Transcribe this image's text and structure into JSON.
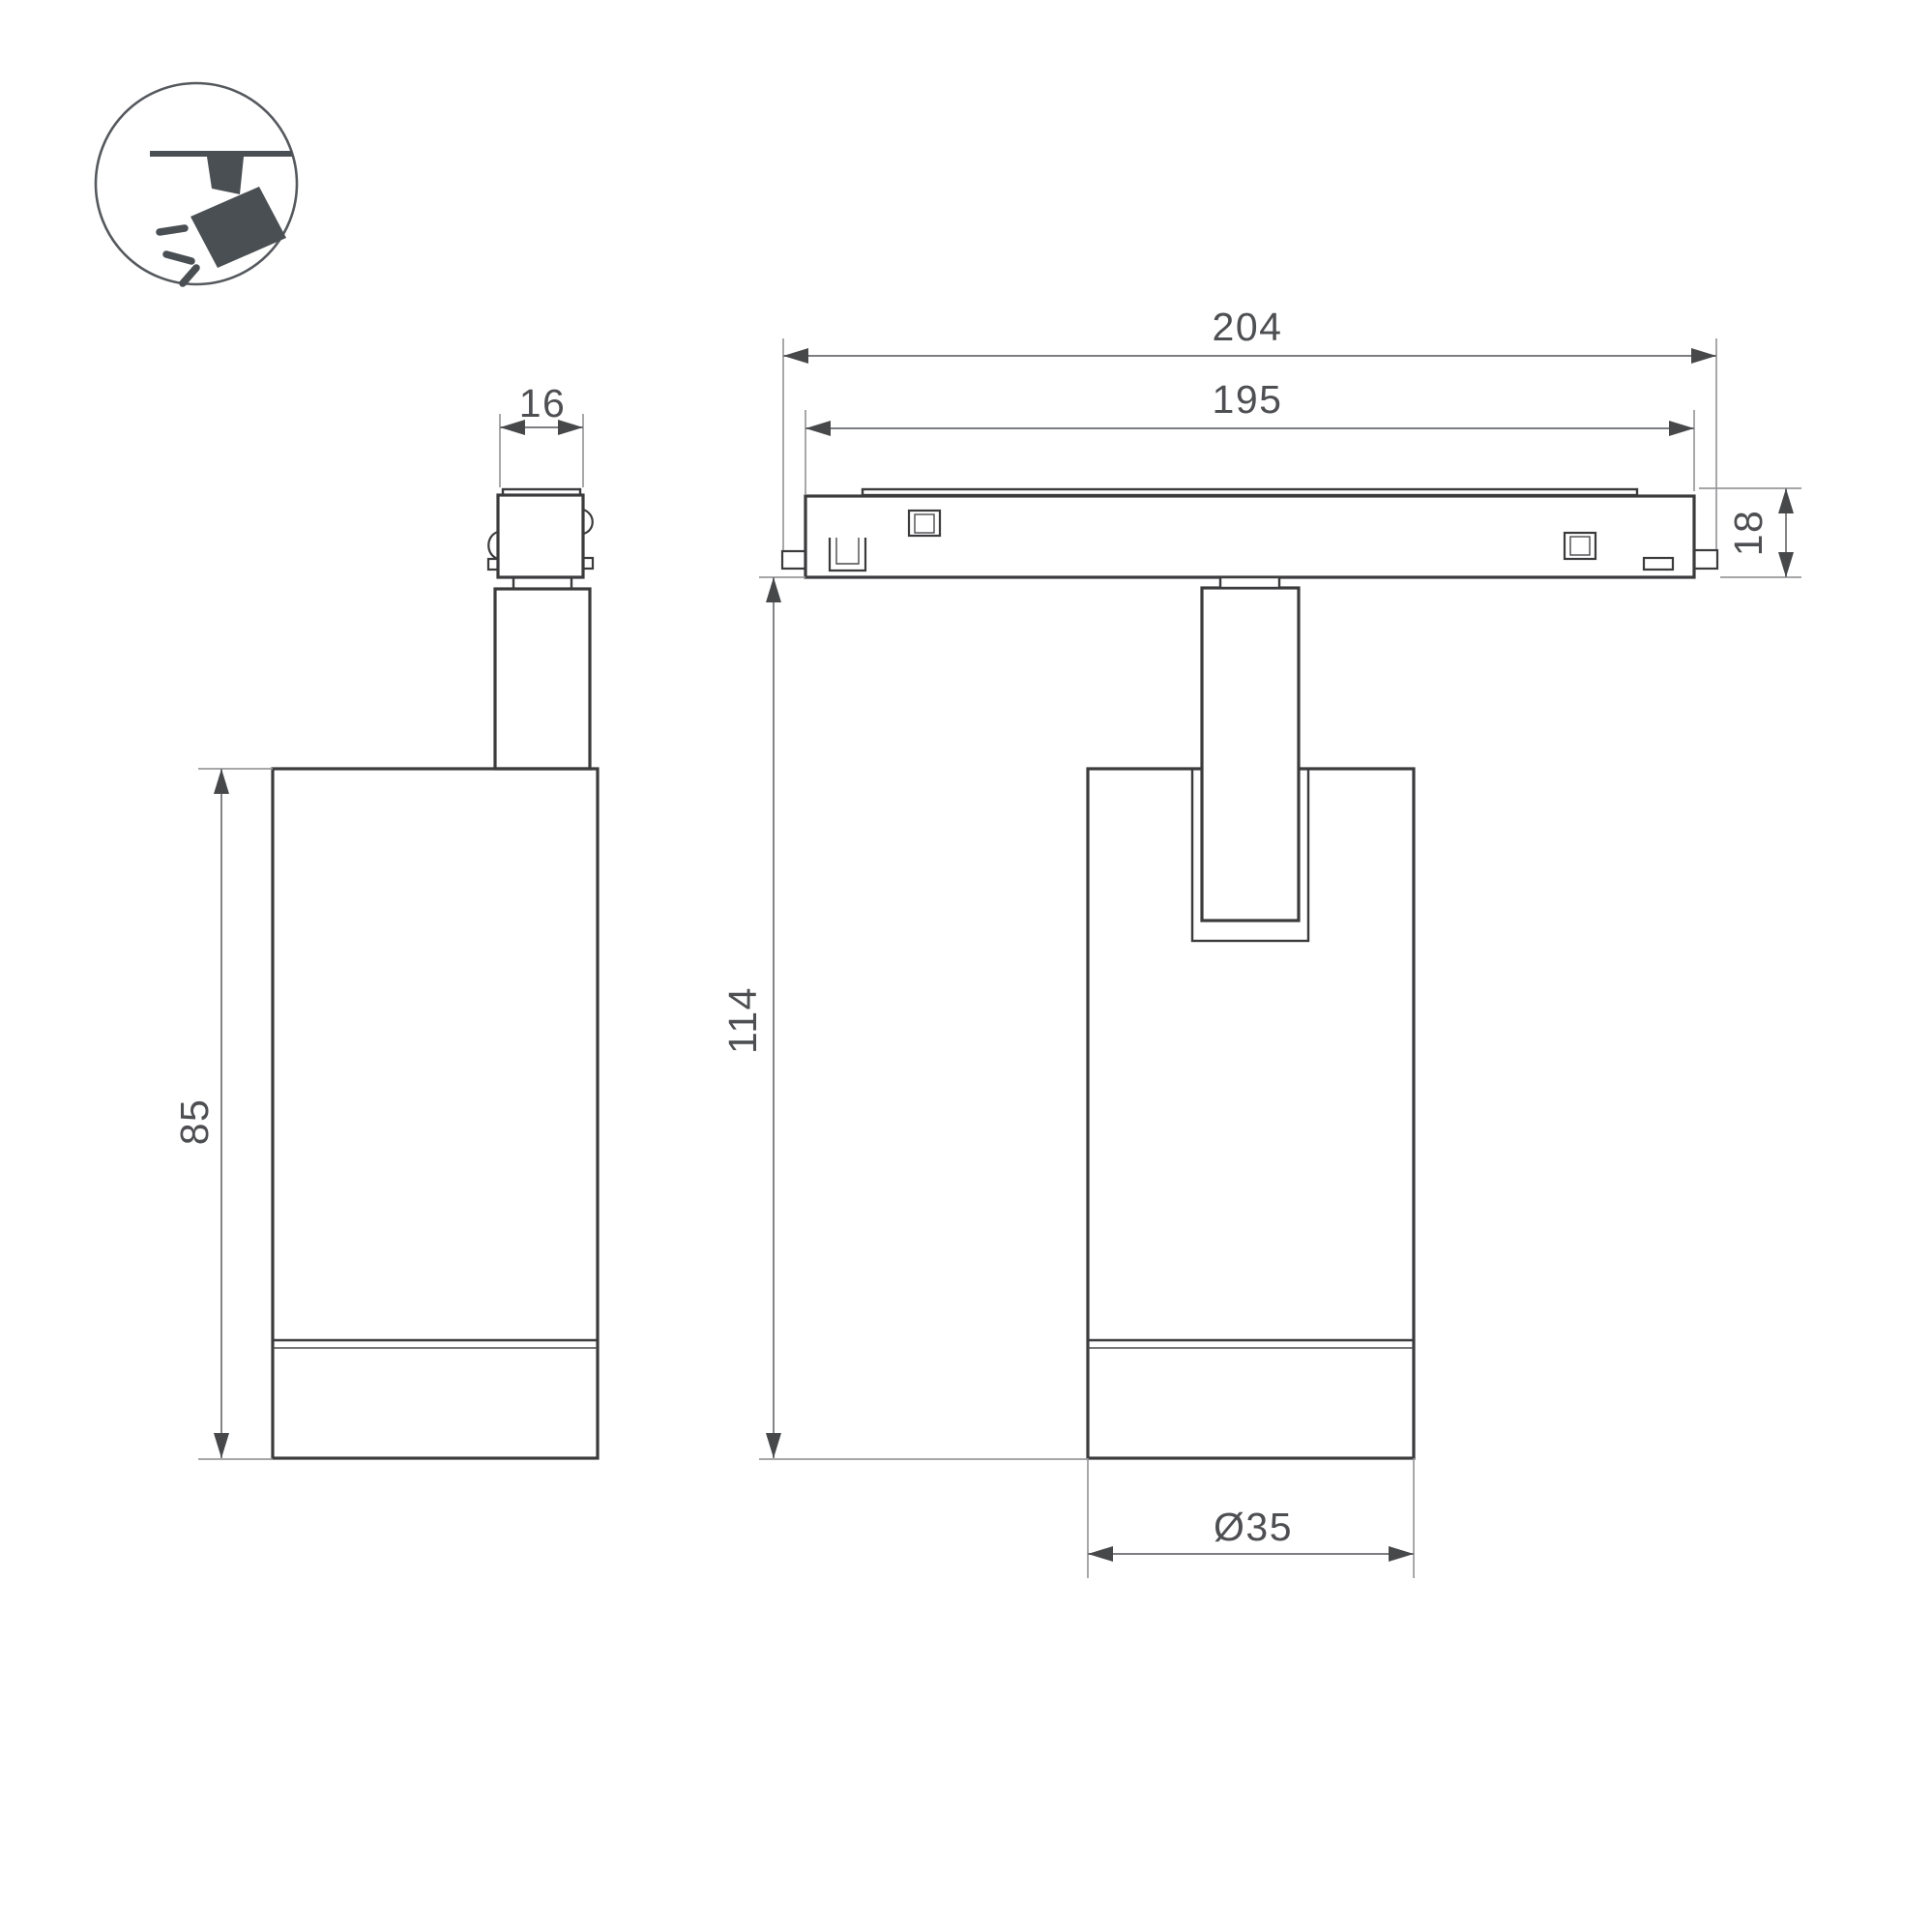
{
  "page": {
    "background": "#ffffff",
    "kind": "technical-dimension-drawing",
    "units": "mm"
  },
  "icon": {
    "name": "ceiling-track-spotlight-pictogram"
  },
  "dims": {
    "connector_width": "16",
    "track_length_outer": "204",
    "track_length_body": "195",
    "track_height": "18",
    "body_height": "85",
    "total_height": "114",
    "body_diameter": "Ø35"
  },
  "colors": {
    "outline": "#3b3b3d",
    "extension_line": "#98999c",
    "dimension_line": "#7d7e81",
    "arrow": "#47484a",
    "text": "#4e4f52",
    "icon_ink": "#4a4f54",
    "background": "#ffffff"
  }
}
